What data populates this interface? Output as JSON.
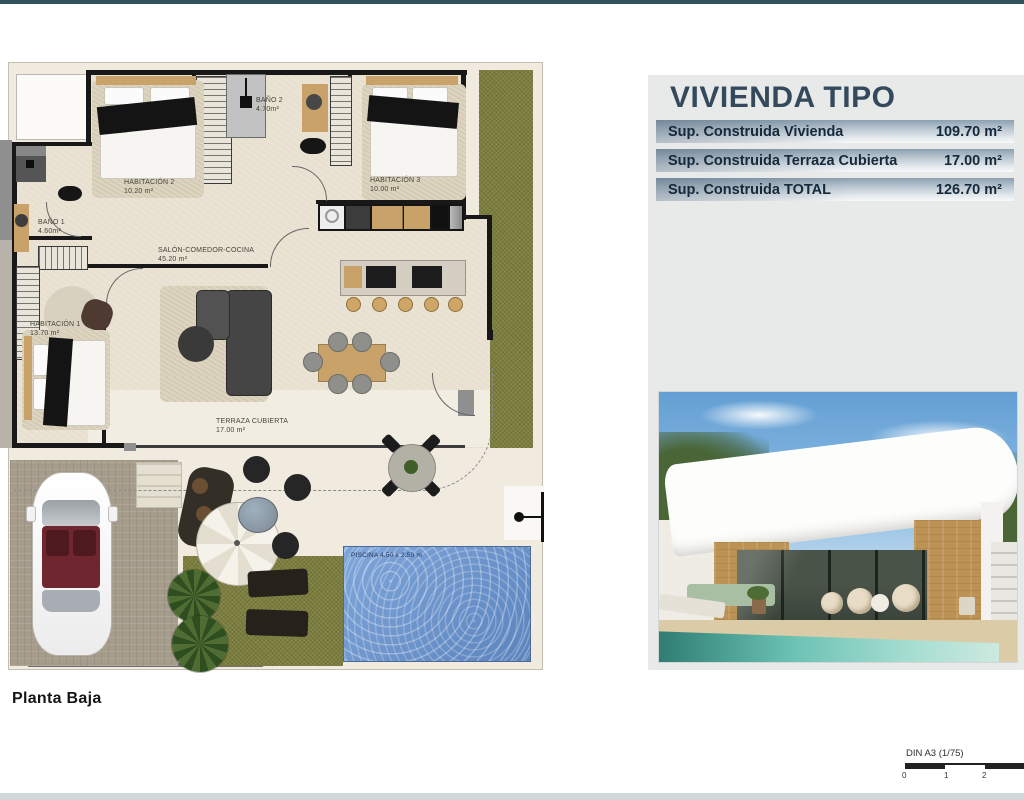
{
  "plan": {
    "title": "Planta Baja",
    "rooms": [
      {
        "name": "HABITACIÓN 2",
        "area": "10.20 m²"
      },
      {
        "name": "BAÑO 2",
        "area": "4.70m²"
      },
      {
        "name": "HABITACIÓN 3",
        "area": "10.00 m²"
      },
      {
        "name": "BAÑO 1",
        "area": "4.60m²"
      },
      {
        "name": "SALÓN-COMEDOR-COCINA",
        "area": "45.20 m²"
      },
      {
        "name": "HABITACIÓN 1",
        "area": "13.70 m²"
      },
      {
        "name": "TERRAZA CUBIERTA",
        "area": "17.00 m²"
      }
    ],
    "pool_label": "PISCINA 4.50 x 2.50 m"
  },
  "info_panel": {
    "title": "VIVIENDA TIPO",
    "rows": [
      {
        "label": "Sup. Construida Vivienda",
        "value": "109.70 m²"
      },
      {
        "label": "Sup. Construida Terraza Cubierta",
        "value": "17.00 m²"
      },
      {
        "label": "Sup. Construida TOTAL",
        "value": "126.70 m²"
      }
    ]
  },
  "scale_bar": {
    "label": "DIN A3 (1/75)",
    "ticks": [
      "0",
      "1",
      "2"
    ]
  },
  "palette": {
    "accent_teal": "#31525c",
    "panel_bg": "#e8eae9",
    "row_text": "#15293a",
    "pool_blue": "#6d97cd",
    "grass_olive": "#7c7e3e"
  }
}
